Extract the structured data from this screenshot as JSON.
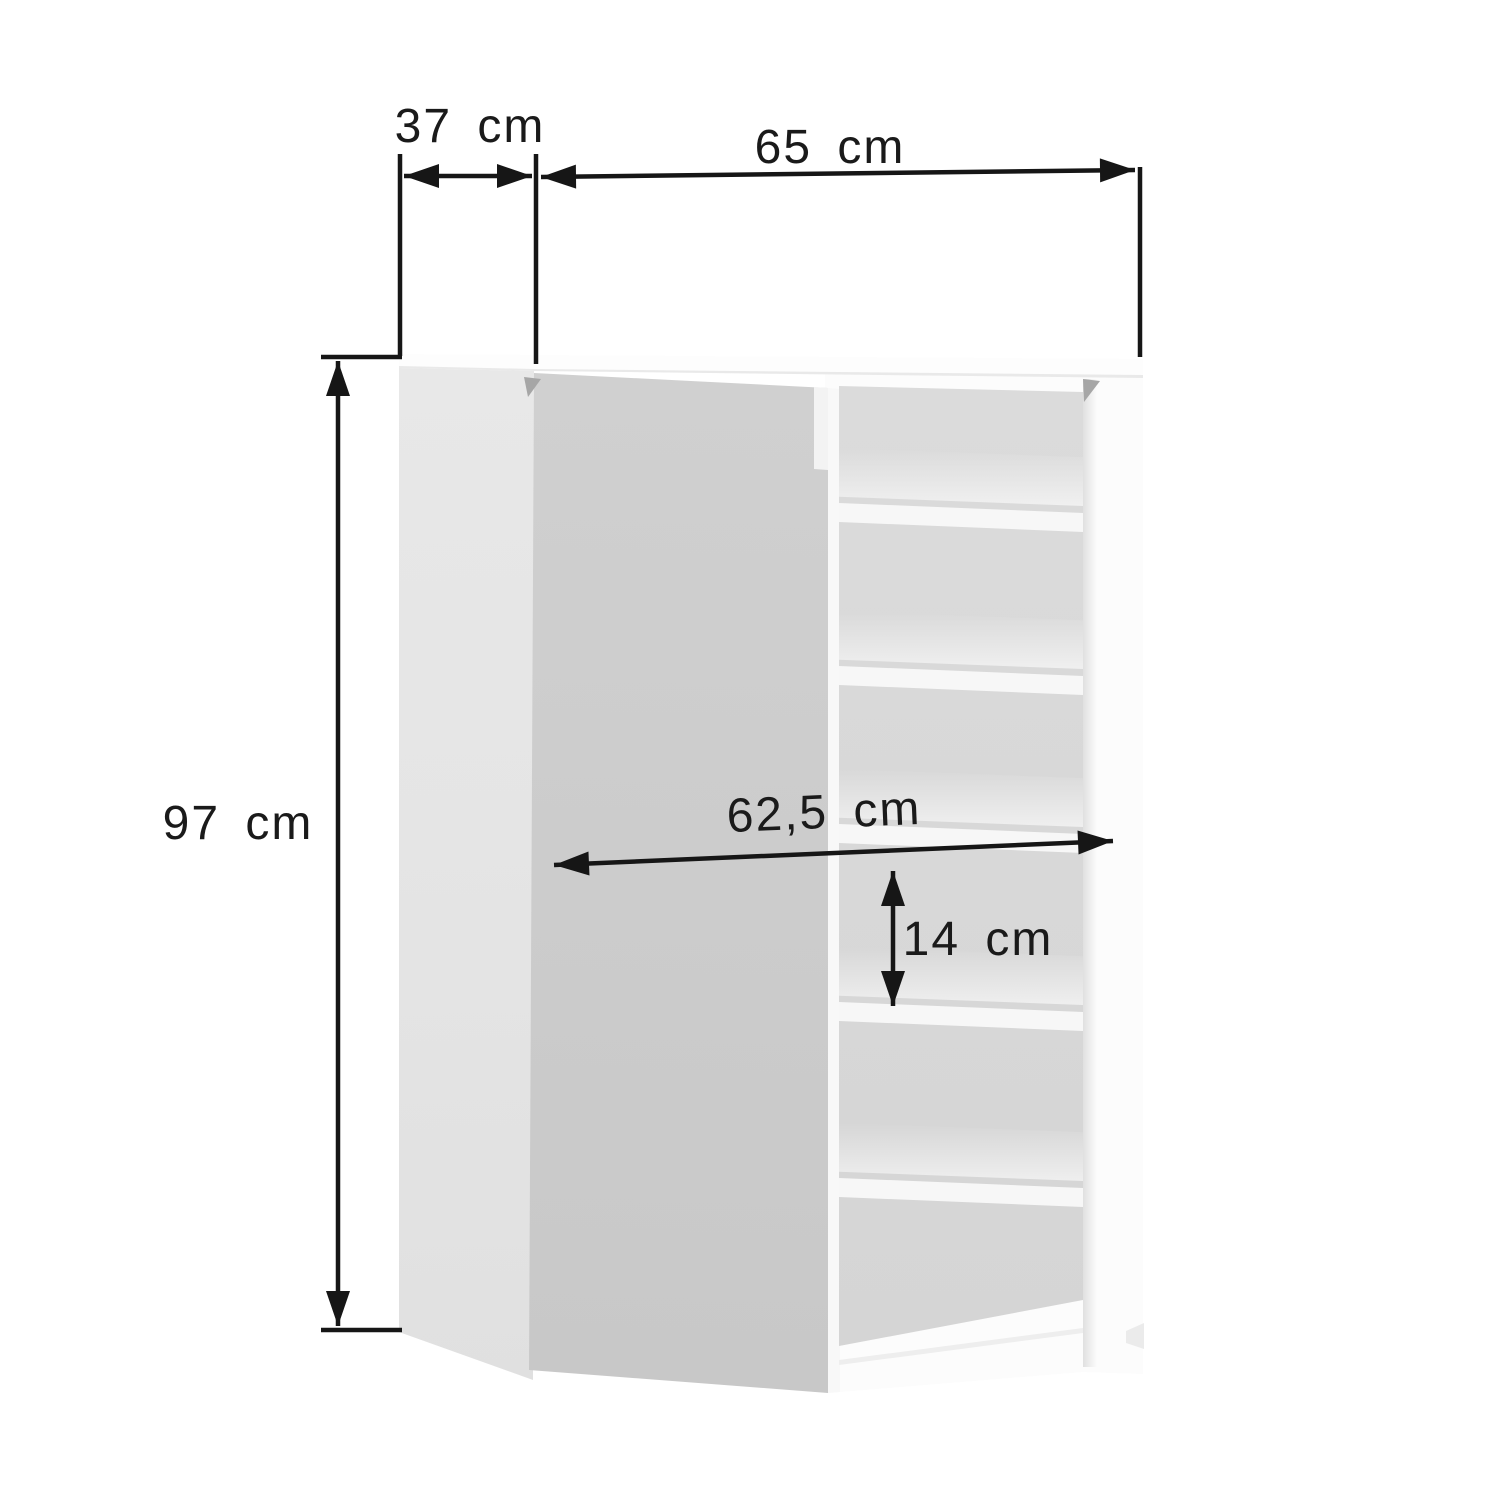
{
  "diagram": {
    "subject": "cabinet dimension drawing with open door and shoe shelves",
    "dimension_labels": {
      "side_depth": "37 cm",
      "front_width": "65 cm",
      "height": "97 cm",
      "inner_width": "62,5 cm",
      "compartment_height": "14 cm"
    },
    "shelf_count": 5
  },
  "colors": {
    "background": "#ffffff",
    "line": "#161616",
    "label": "#1a1a1a",
    "door": "#cdcdcd",
    "side_panel": "#e5e5e5",
    "interior": "#d9d9d9",
    "shelf": "#f7f7f7",
    "top_panel": "#fdfdfd",
    "carcass": "#fcfcfc",
    "notch": "#f3f3f3",
    "divider": "#f8f8f8",
    "wedge": "#a6a6a6",
    "foot": "#ebebeb"
  }
}
